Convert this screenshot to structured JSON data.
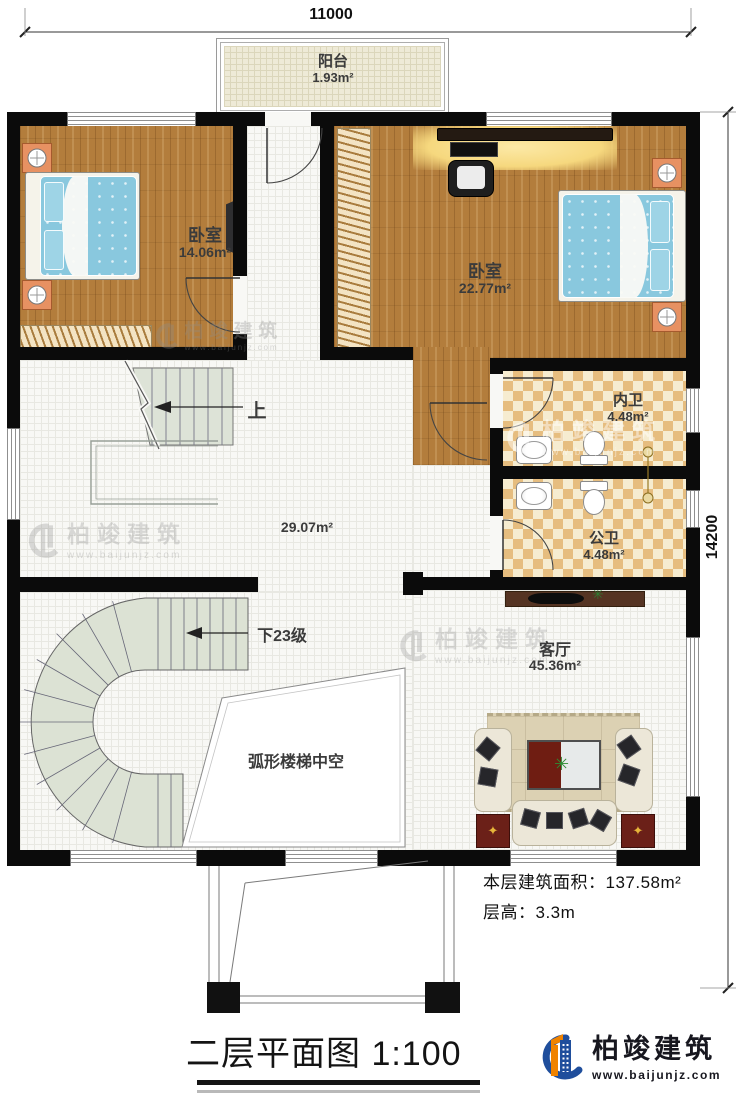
{
  "dimensions": {
    "top": "11000",
    "right": "14200"
  },
  "rooms": {
    "balcony": {
      "name": "阳台",
      "area": "1.93m²"
    },
    "bedroom1": {
      "name": "卧室",
      "area": "14.06m²"
    },
    "bedroom2": {
      "name": "卧室",
      "area": "22.77m²"
    },
    "inner_bath": {
      "name": "内卫",
      "area": "4.48m²"
    },
    "public_bath": {
      "name": "公卫",
      "area": "4.48m²"
    },
    "hall": {
      "area": "29.07m²"
    },
    "living": {
      "name": "客厅",
      "area": "45.36m²"
    },
    "stair_void": {
      "label": "弧形楼梯中空"
    }
  },
  "stairs": {
    "up": "上",
    "down": "下23级"
  },
  "notes": {
    "area_label": "本层建筑面积：",
    "area_value": "137.58m²",
    "height_label": "层高：",
    "height_value": "3.3m"
  },
  "footer": {
    "title": "二层平面图",
    "scale": "1:100"
  },
  "brand": {
    "name": "柏竣建筑",
    "site": "www.baijunjz.com"
  },
  "colors": {
    "wall": "#0b0b0b",
    "wood": "#b37d3c",
    "tile_checker": "#e6bd7f",
    "stair": "#dde3d7",
    "bed": "#89c8de",
    "logo_blue": "#1f4e9c",
    "logo_orange": "#f08300"
  }
}
